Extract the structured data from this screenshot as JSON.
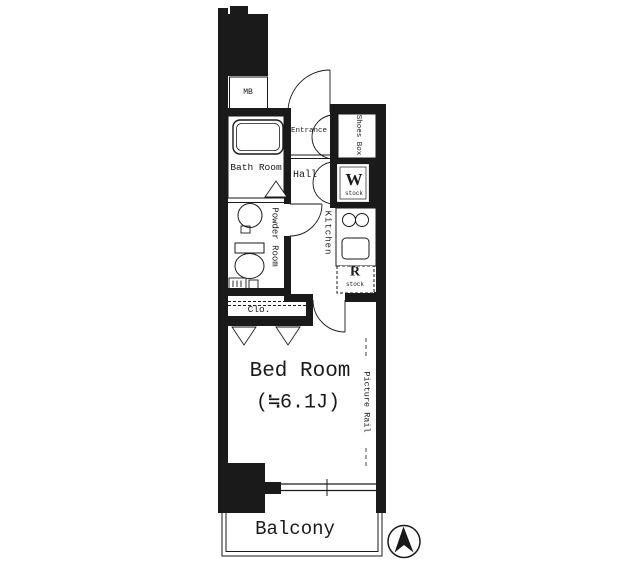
{
  "plan": {
    "rooms": {
      "meter_box": {
        "label": "MB"
      },
      "bath": {
        "label": "Bath Room"
      },
      "entrance": {
        "label": "Entrance"
      },
      "shoes_box": {
        "label": "Shoes Box"
      },
      "hall": {
        "label": "Hall"
      },
      "washer_space": {
        "letter": "W",
        "sub": "stock"
      },
      "kitchen": {
        "label": "Kitchen"
      },
      "refrigerator_space": {
        "letter": "R",
        "sub": "stock"
      },
      "powder_room": {
        "label": "Powder Room"
      },
      "closet": {
        "label": "Clo."
      },
      "bedroom": {
        "label": "Bed Room",
        "size": "(≒6.1J)"
      },
      "balcony": {
        "label": "Balcony"
      }
    },
    "annotations": {
      "picture_rail": "Picture Rail"
    },
    "colors": {
      "line": "#1a1a1a",
      "background": "#ffffff"
    }
  }
}
